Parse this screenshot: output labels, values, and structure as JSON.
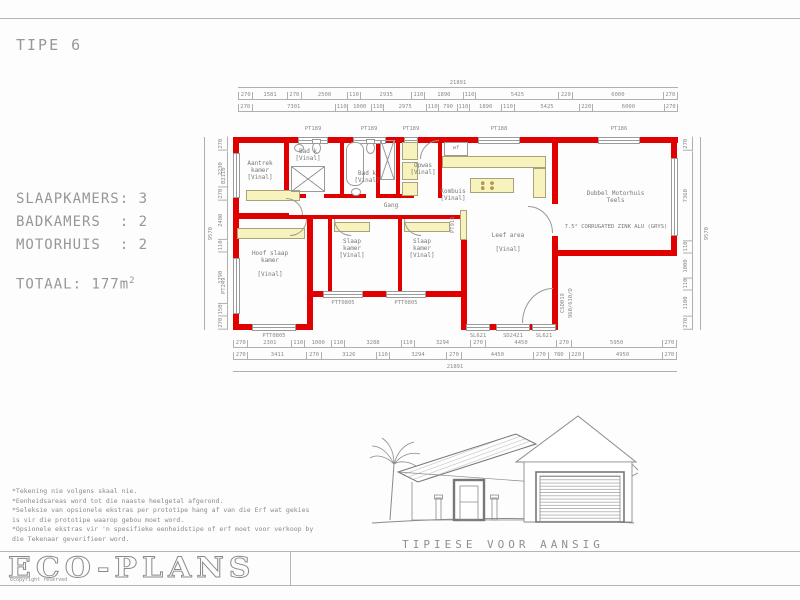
{
  "sheet": {
    "title": "TIPE 6"
  },
  "specs": {
    "lines": [
      "SLAAPKAMERS: 3",
      "BADKAMERS  : 2",
      "MOTORHUIS  : 2"
    ],
    "total_label": "TOTAAL:",
    "total_value": "  177m",
    "total_sup": "2"
  },
  "plan": {
    "rooms": {
      "aantrek": "Aantrek\nkamer\n[Vinal]",
      "hoof_slaap": "Hoof slaap\nkamer\n\n[Vinal]",
      "bad1": "Bad k\n[Vinal]",
      "bad2": "Bad k\n[Vinal]",
      "opwas": "Opwas\n[Vinal]",
      "kombuis": "Kombuis\n[Vinal]",
      "gang": "Gang",
      "slaap1": "Slaap\nkamer\n[Vinal]",
      "slaap2": "Slaap\nkamer\n[Vinal]",
      "leef": "Leef area\n\n[Vinal]",
      "motorhuis": "Dubbel Motorhuis\nTeels",
      "roof_note": "7.5° CORRUGATED ZINK ALU (GRYS)",
      "fixture": "wf"
    },
    "codes": {
      "top": [
        "PT189",
        "PT189",
        "PT189",
        "PT188",
        "PT186"
      ],
      "bottom_left": "PTT0805",
      "bottom_mid1": "PTT0805",
      "bottom_mid2": "PTT0805",
      "slider_left": "SL621",
      "slider_mid": "SD2421",
      "slider_right": "SL621",
      "left_upper": "B2110",
      "left_lower": "PT249",
      "leef_right": "PT916",
      "door1": "CSD019",
      "door2": "960/610/D"
    },
    "dims": {
      "top_total": "21891",
      "top_row1": [
        "270",
        "1581",
        "270",
        "2500",
        "110",
        "2935",
        "110",
        "1890",
        "110",
        "5425",
        "220",
        "6000",
        "270"
      ],
      "top_row2": [
        "270",
        "7301",
        "110",
        "1000",
        "110",
        "2975",
        "110",
        "790",
        "110",
        "1890",
        "110",
        "5425",
        "220",
        "6000",
        "270"
      ],
      "bottom_row1": [
        "270",
        "2301",
        "110",
        "1000",
        "110",
        "3288",
        "110",
        "3294",
        "270",
        "4450",
        "270",
        "5950",
        "270"
      ],
      "bottom_row2": [
        "270",
        "3411",
        "270",
        "3126",
        "110",
        "3294",
        "270",
        "4450",
        "270",
        "780",
        "220",
        "4950",
        "270"
      ],
      "bottom_total": "21891",
      "left_total": "9570",
      "left_chain": [
        "270",
        "2230",
        "270",
        "2480",
        "110",
        "3790",
        "150",
        "270"
      ],
      "right_total": "9570",
      "right_chain": [
        "270",
        "7360",
        "110",
        "1000",
        "110",
        "1100",
        "270"
      ]
    }
  },
  "elevation": {
    "caption": "TIPIESE VOOR AANSIG"
  },
  "notes": [
    "*Tekening nie volgens skaal nie.",
    "*Eenheidsareas word tot die naaste heelgetal afgerond.",
    "*Seleksie van opsionele ekstras per prototipe hang af van die Erf wat gekies",
    "is vir die prototipe waarop gebou moet word.",
    "*Opsionele ekstras vir 'n spesifieke eenheidstipe of erf moet voor verkoop by",
    "die Tekenaar geverifieer word.",
    ""
  ],
  "footer": {
    "logo": "ECO-PLANS",
    "copyright": "©copyright reserved"
  }
}
